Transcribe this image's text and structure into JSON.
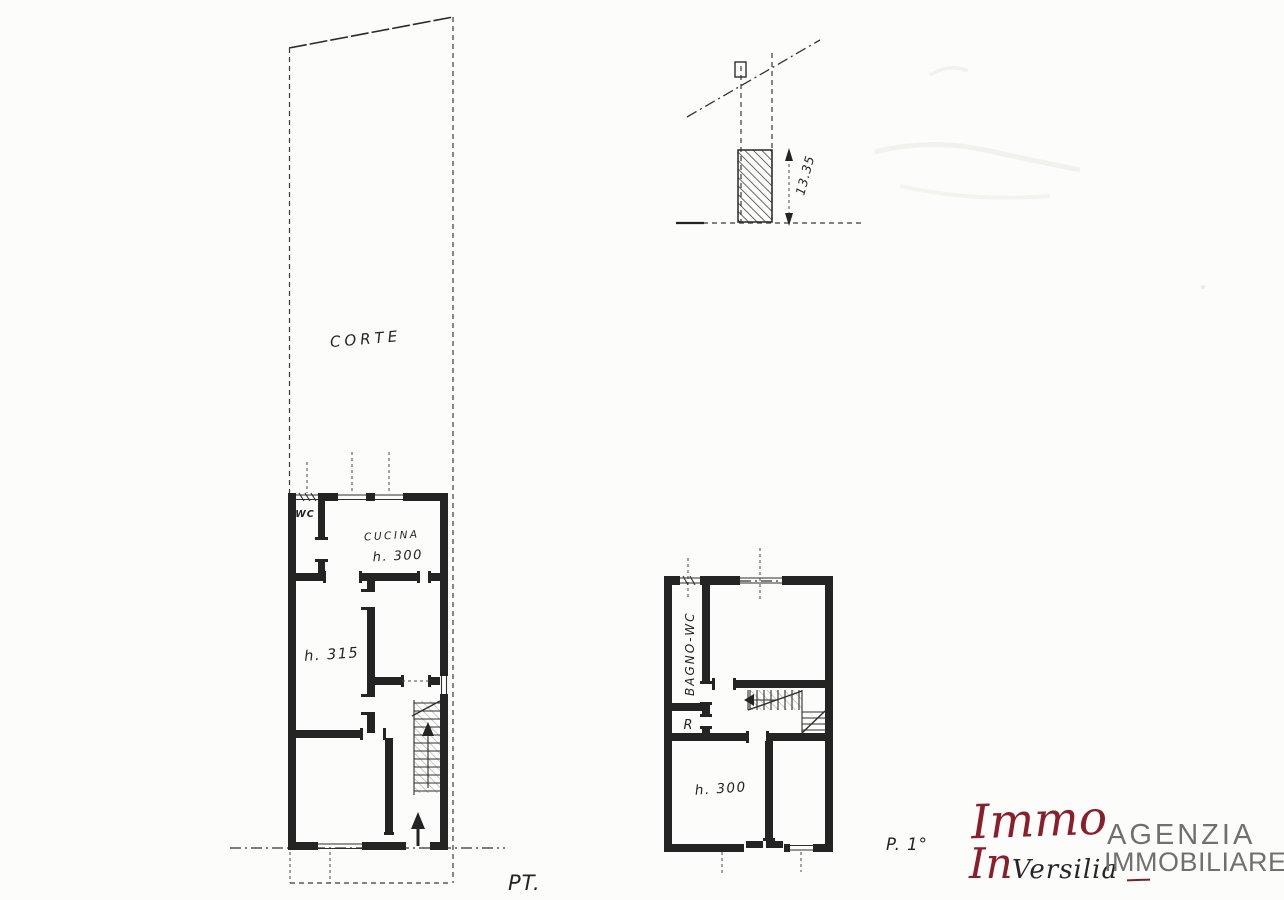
{
  "sheet": {
    "paper_color": "#fcfcfa",
    "ink_color": "#242424",
    "accent_color": "#8a1e2d",
    "agency_text_color": "#707070"
  },
  "site_plan": {
    "courtyard_label": "CORTE"
  },
  "ground_floor": {
    "floor_label": "PT.",
    "wc_label": "WC",
    "kitchen_label": "CUCINA",
    "kitchen_height": "h. 300",
    "main_room_height": "h. 315"
  },
  "section": {
    "height_dimension": "13.35"
  },
  "first_floor": {
    "floor_label": "P. 1°",
    "bathroom_label": "BAGNO-WC",
    "storage_label": "R",
    "bedroom_height": "h. 300"
  },
  "logo": {
    "script_top": "Immo",
    "script_accent": "In",
    "script_rest": "Versilia",
    "agency_line1": "AGENZIA",
    "agency_line2": "IMMOBILIARE"
  }
}
